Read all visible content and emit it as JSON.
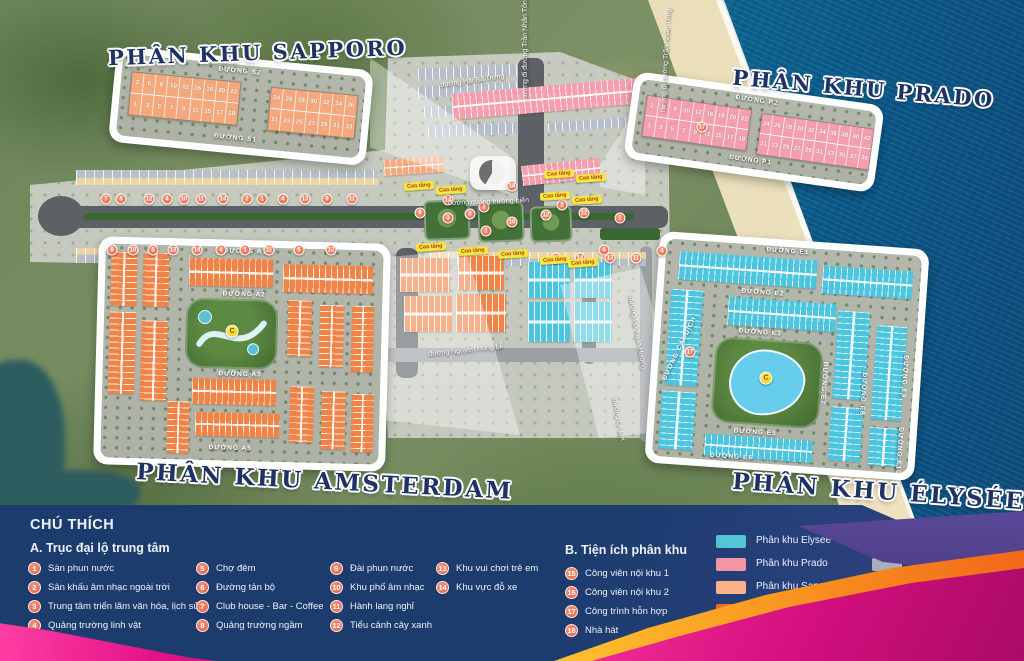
{
  "poster": {
    "zones": {
      "sapporo": {
        "title": "PHÂN KHU SAPPORO",
        "road_top": "ĐƯỜNG S2",
        "road_bottom": "ĐƯỜNG S1",
        "block1_top": [
          "2",
          "6",
          "8",
          "10",
          "12",
          "16",
          "18",
          "20",
          "22"
        ],
        "block1_bottom": [
          "1",
          "3",
          "5",
          "7",
          "9",
          "11",
          "15",
          "17",
          "19"
        ],
        "block2_top": [
          "24",
          "26",
          "28",
          "30",
          "32",
          "34",
          "36"
        ],
        "block2_bottom": [
          "21",
          "23",
          "25",
          "27",
          "29",
          "31",
          "33"
        ]
      },
      "prado": {
        "title": "PHÂN KHU PRADO",
        "road_top": "ĐƯỜNG P2",
        "road_bottom": "ĐƯỜNG P1",
        "block1_top": [
          "2",
          "6",
          "8",
          "10",
          "12",
          "16",
          "18",
          "20",
          "22"
        ],
        "block1_bottom": [
          "1",
          "3",
          "5",
          "7",
          "9",
          "11",
          "15",
          "17",
          "19"
        ],
        "block2_top": [
          "24",
          "26",
          "28",
          "30",
          "32",
          "34",
          "36",
          "38",
          "40",
          "42"
        ],
        "block2_bottom": [
          "21",
          "23",
          "25",
          "27",
          "29",
          "31",
          "33",
          "35",
          "37",
          "39"
        ]
      },
      "amsterdam": {
        "title": "PHÂN KHU AMSTERDAM",
        "roads": [
          "ĐƯỜNG A1",
          "ĐƯỜNG A2",
          "ĐƯỜNG A3",
          "ĐƯỜNG A5"
        ],
        "park_marker": "C"
      },
      "elysee": {
        "title": "PHÂN KHU ÉLYSÉE",
        "roads_h": [
          "ĐƯỜNG E1",
          "ĐƯỜNG E2",
          "ĐƯỜNG E3",
          "ĐƯỜNG E5",
          "ĐƯỜNG E6"
        ],
        "roads_v": [
          "ĐƯỜNG E7",
          "ĐƯỜNG E8",
          "ĐƯỜNG E9",
          "ĐƯỜNG E10"
        ],
        "road_diag": "ĐƯỜNG CẢI DỊCH",
        "lake_marker": "C"
      }
    },
    "road_labels": [
      {
        "text": "đường Hai Bà Trưng",
        "x": 440,
        "y": 82,
        "rot": -8
      },
      {
        "text": "hướng đi đường Trần Nhân Tông",
        "x": 522,
        "y": 100,
        "rot": -90
      },
      {
        "text": "hướng đi đường Trần Nhân Tông",
        "x": 660,
        "y": 112,
        "rot": -87
      },
      {
        "text": "đường quảng trường biển",
        "x": 448,
        "y": 200,
        "rot": -2
      },
      {
        "text": "đường Nguyễn Hùng Lễ",
        "x": 428,
        "y": 351,
        "rot": -6
      },
      {
        "text": "đường Hồ Xuân Hương",
        "x": 634,
        "y": 296,
        "rot": 80
      },
      {
        "text": "đường Lê Lợi",
        "x": 618,
        "y": 398,
        "rot": 80
      }
    ],
    "high_rise_label": "Cao tầng",
    "high_rise_positions": [
      [
        404,
        182
      ],
      [
        436,
        186
      ],
      [
        544,
        170
      ],
      [
        576,
        174
      ],
      [
        540,
        192
      ],
      [
        572,
        196
      ],
      [
        416,
        243
      ],
      [
        458,
        247
      ],
      [
        498,
        250
      ],
      [
        540,
        256
      ],
      [
        568,
        259
      ]
    ],
    "markers": [
      {
        "n": "7",
        "x": 106,
        "y": 199
      },
      {
        "n": "8",
        "x": 121,
        "y": 199
      },
      {
        "n": "12",
        "x": 149,
        "y": 199
      },
      {
        "n": "4",
        "x": 167,
        "y": 199
      },
      {
        "n": "10",
        "x": 184,
        "y": 199
      },
      {
        "n": "11",
        "x": 201,
        "y": 199
      },
      {
        "n": "14",
        "x": 223,
        "y": 199
      },
      {
        "n": "2",
        "x": 247,
        "y": 199
      },
      {
        "n": "1",
        "x": 262,
        "y": 199
      },
      {
        "n": "4",
        "x": 283,
        "y": 199
      },
      {
        "n": "13",
        "x": 305,
        "y": 199
      },
      {
        "n": "9",
        "x": 327,
        "y": 199
      },
      {
        "n": "11",
        "x": 352,
        "y": 199
      },
      {
        "n": "9",
        "x": 112,
        "y": 250
      },
      {
        "n": "10",
        "x": 133,
        "y": 250
      },
      {
        "n": "5",
        "x": 153,
        "y": 250
      },
      {
        "n": "13",
        "x": 173,
        "y": 250
      },
      {
        "n": "14",
        "x": 197,
        "y": 250
      },
      {
        "n": "4",
        "x": 221,
        "y": 250
      },
      {
        "n": "1",
        "x": 245,
        "y": 250
      },
      {
        "n": "11",
        "x": 269,
        "y": 250
      },
      {
        "n": "6",
        "x": 299,
        "y": 250
      },
      {
        "n": "12",
        "x": 331,
        "y": 250
      },
      {
        "n": "14",
        "x": 448,
        "y": 200
      },
      {
        "n": "9",
        "x": 420,
        "y": 213
      },
      {
        "n": "3",
        "x": 448,
        "y": 218
      },
      {
        "n": "8",
        "x": 470,
        "y": 214
      },
      {
        "n": "2",
        "x": 484,
        "y": 207
      },
      {
        "n": "1",
        "x": 486,
        "y": 231
      },
      {
        "n": "18",
        "x": 512,
        "y": 186
      },
      {
        "n": "10",
        "x": 512,
        "y": 222
      },
      {
        "n": "12",
        "x": 546,
        "y": 215
      },
      {
        "n": "2",
        "x": 562,
        "y": 205
      },
      {
        "n": "12",
        "x": 584,
        "y": 213
      },
      {
        "n": "1",
        "x": 620,
        "y": 218
      },
      {
        "n": "4",
        "x": 604,
        "y": 250
      },
      {
        "n": "4",
        "x": 662,
        "y": 251
      },
      {
        "n": "10",
        "x": 556,
        "y": 258
      },
      {
        "n": "14",
        "x": 580,
        "y": 258
      },
      {
        "n": "13",
        "x": 610,
        "y": 258
      },
      {
        "n": "11",
        "x": 636,
        "y": 258
      },
      {
        "n": "17",
        "x": 702,
        "y": 127
      },
      {
        "n": "17",
        "x": 690,
        "y": 352
      }
    ]
  },
  "legend": {
    "title": "CHÚ THÍCH",
    "section_a": {
      "title": "A. Trục đại lộ trung tâm",
      "columns": [
        [
          {
            "n": "1",
            "label": "Sàn phun nước"
          },
          {
            "n": "2",
            "label": "Sân khấu âm nhạc ngoài trời"
          },
          {
            "n": "3",
            "label": "Trung tâm triển lãm văn hóa, lịch sử"
          },
          {
            "n": "4",
            "label": "Quảng trường linh vật"
          }
        ],
        [
          {
            "n": "5",
            "label": "Chợ đêm"
          },
          {
            "n": "6",
            "label": "Đường tản bộ"
          },
          {
            "n": "7",
            "label": "Club house - Bar - Coffee"
          },
          {
            "n": "8",
            "label": "Quảng trường ngầm"
          }
        ],
        [
          {
            "n": "9",
            "label": "Đài phun nước"
          },
          {
            "n": "10",
            "label": "Khu phố âm nhạc"
          },
          {
            "n": "11",
            "label": "Hành lang nghỉ"
          },
          {
            "n": "12",
            "label": "Tiểu cảnh cây xanh"
          }
        ],
        [
          {
            "n": "13",
            "label": "Khu vui chơi trẻ em"
          },
          {
            "n": "14",
            "label": "Khu vực đỗ xe"
          }
        ]
      ]
    },
    "section_b": {
      "title": "B. Tiện ích phân khu",
      "items": [
        {
          "n": "15",
          "label": "Công viên nội khu 1"
        },
        {
          "n": "16",
          "label": "Công viên nội khu 2"
        },
        {
          "n": "17",
          "label": "Công trình hỗn hợp"
        },
        {
          "n": "18",
          "label": "Nhà hát"
        }
      ]
    },
    "swatch_columns": [
      [
        {
          "color": "#54c5d4",
          "label": "Phân khu Elysee"
        },
        {
          "color": "#f495a5",
          "label": "Phân khu Prado"
        },
        {
          "color": "#f9b289",
          "label": "Phân khu Sapporo"
        },
        {
          "color": "#ee7024",
          "label": "Phân khu Amsterdam"
        },
        {
          "color": "#f3d7a6",
          "label": "Phân khu Broadway"
        }
      ],
      [
        {
          "color": "#f2ea1d",
          "label": "Chung cư"
        },
        {
          "color": "#a9aeba",
          "label": "Khu đô thị mới"
        },
        {
          "color": "#98d2ad",
          "label": "Khách sạn Mini"
        },
        {
          "color": "#cfc7cb",
          "label": "Khu hiện trạng",
          "label2": "(Khách sạn, nhà hàng, dv, ...)"
        }
      ]
    ]
  }
}
